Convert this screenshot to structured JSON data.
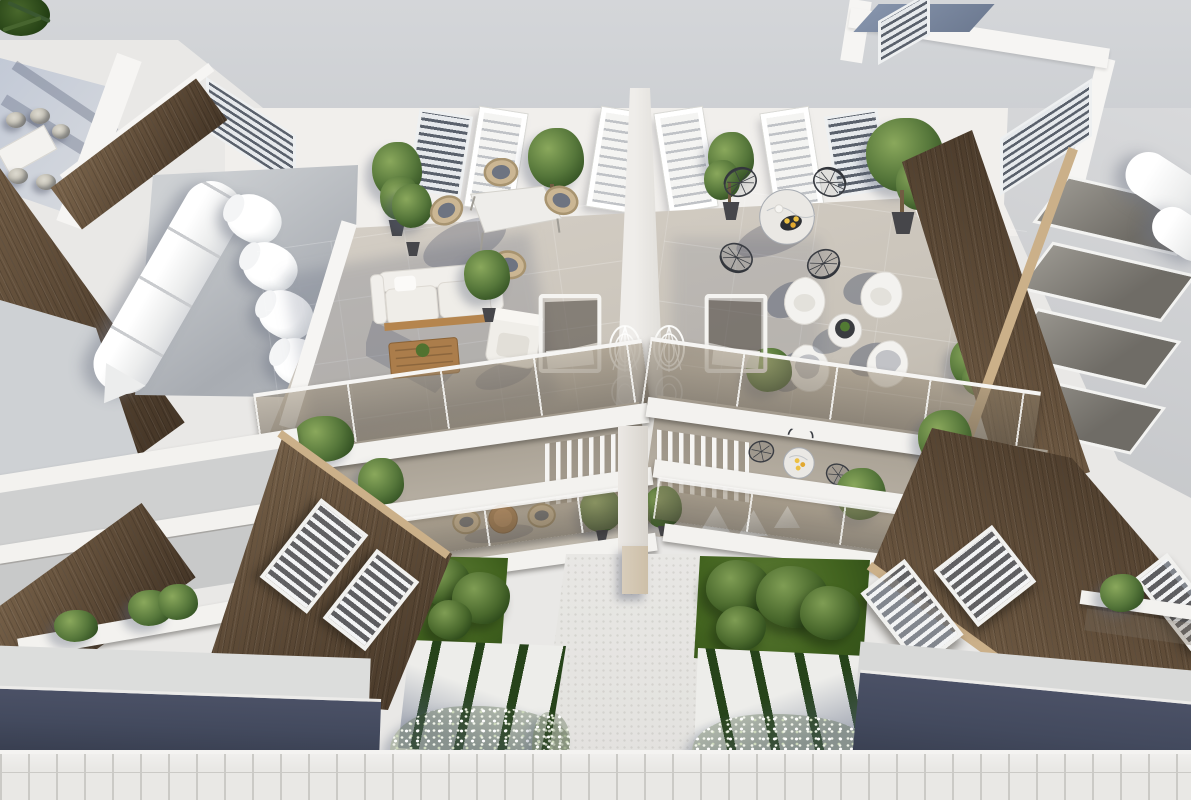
{
  "meta": {
    "description": "Aerial 3D architectural rendering of a modern white duplex residence with two mirrored rooftop terraces, wood-clad sloping facades, balconies, gardens and street frontage",
    "render_type": "architectural-visualization",
    "visible_text": "none"
  },
  "palette": {
    "sceneBg": "#e9e8e6",
    "roofGray": "#d4d6d9",
    "roofGrayDeep": "#c8cbcf",
    "roofFace": "#f1efec",
    "rightPlane": "#d8d9db",
    "terraceFloor": "#d6d0c7",
    "terraceFloorDeep": "#bcb5aa",
    "recess": "#b3ab9e",
    "divider": "#efedea",
    "slabWhite": "#f3f2ef",
    "parapetWhite": "#f6f5f3",
    "wood": "#5f4c38",
    "woodL": "#7b654c",
    "woodD": "#443526",
    "woodEdge": "#cbb089",
    "lawnLight": "#5d7c35",
    "lawn": "#42631f",
    "lawnDark": "#2a4715",
    "bushLight": "#7f9d54",
    "bushMid": "#49682c",
    "bushDark": "#233f14",
    "foliageLight": "#8aa85c",
    "foliageMid": "#55763a",
    "foliageDark": "#2f4d20",
    "potDark": "#46464a",
    "road": "#434a5e",
    "roadDark": "#363c4d",
    "sidewalk": "#e9e8e5",
    "grout": "#cbcac6",
    "pathLight": "#e8e7e4",
    "stoneWhite": "#ededea",
    "stoneGap": "#26431a",
    "louverSlat": "#5a616c",
    "skyGlaz": "#f4f4f2",
    "blueShadow": "#8593ab",
    "marble": "#eae8e4",
    "wireChair": "#3a3d43",
    "lemon": "#ecc043",
    "rattan": "#cbb693",
    "cushion": "#6e7481",
    "woodTable": "#aa7c4a",
    "eggWhite": "#f3f2ef",
    "tankWhite": "#ffffff",
    "panelDark": "#6f6c66",
    "pillar": "#cdbfa8",
    "neighborA": "#c2c9d6",
    "neighborB": "#dcdee1"
  },
  "scene": {
    "top_roof": {
      "courtyard_trees": 8,
      "dome_vents": 2,
      "corner_louver_vents": 1,
      "parapet": "white band"
    },
    "upper_roof_face": {
      "skylights": 4,
      "louver_vents": 4
    },
    "left_wing_roof": {
      "water_tanks": 4,
      "solar_tube": "long white cylinder"
    },
    "right_wing_roof": {
      "solar_panels": 4,
      "water_cylinders": 2
    },
    "left_terrace": {
      "furniture": [
        "square dining table",
        "rattan chair x4",
        "two-seat outdoor sofa",
        "wooden coffee table",
        "armchair",
        "sun lounger",
        "spiral wire chair"
      ],
      "plants": 4
    },
    "right_terrace": {
      "furniture": [
        "round marble bistro table",
        "black wire chair x4",
        "white egg chair x4",
        "round side table",
        "sun lounger",
        "spiral wire chair"
      ],
      "plants": 4
    },
    "middle_level": {
      "pergola_slat_screens": 2,
      "glass_balustrades": 4,
      "wicker_bistro_set": 1,
      "marble_bistro_set": 1,
      "louvered_windows": 5,
      "white_cover_chairs": 3
    },
    "ground_level": {
      "lawns": 2,
      "garden_bushes": 7,
      "stepping_stone_beds": 2,
      "flower_beds": 3,
      "central_path": 1,
      "roads": 2,
      "sidewalk": 1
    },
    "neighbors": {
      "left_rooftop_dining_set": {
        "table": 1,
        "chairs": 5
      },
      "right_unit_balcony": 1
    }
  }
}
